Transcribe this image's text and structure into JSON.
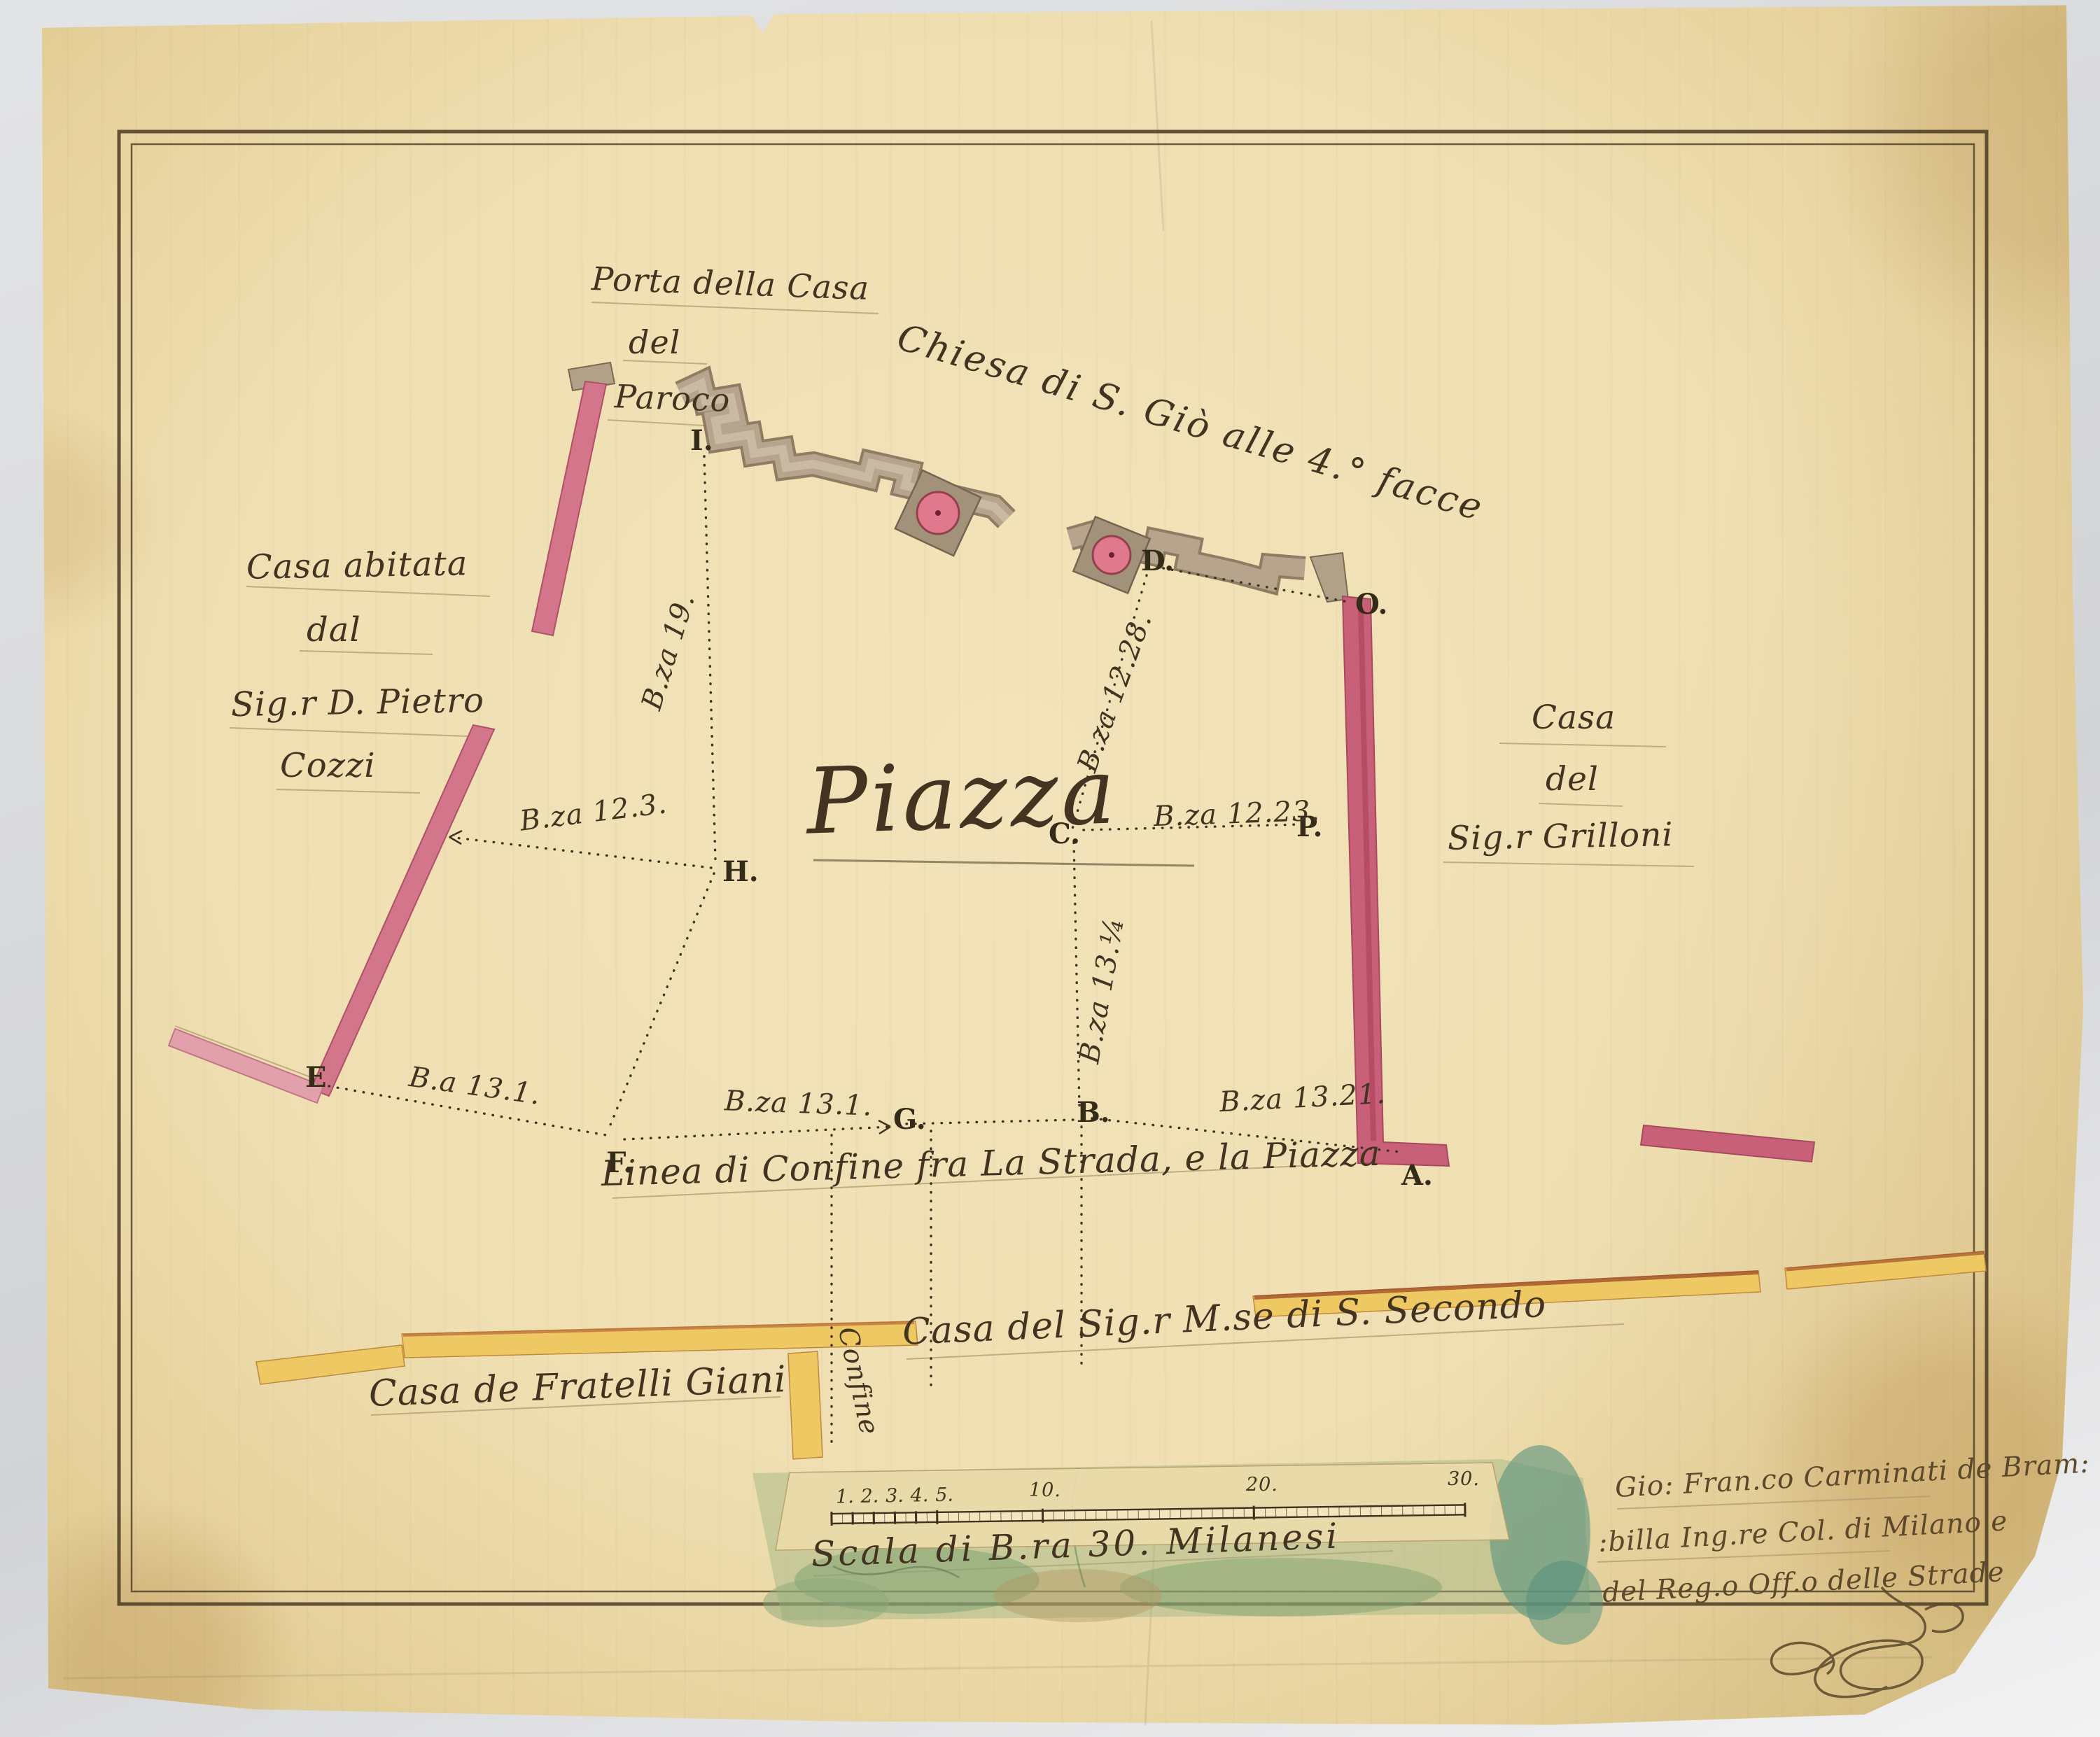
{
  "map": {
    "piazza_label": "Piazza",
    "church_label": "Chiesa di S. Giò alle 4.° facce",
    "boundary_line_label": "Linea di Confine fra La Strada, e la Piazza",
    "porta_lines": [
      "Porta della Casa",
      "del",
      "Paroco"
    ],
    "casa_cozzi_lines": [
      "Casa abitata",
      "dal",
      "Sig.r D. Pietro",
      "Cozzi"
    ],
    "casa_grilloni_lines": [
      "Casa",
      "del",
      "Sig.r Grilloni"
    ],
    "casa_giani_label": "Casa de Fratelli Giani",
    "casa_secondo_label": "Casa del Sig.r M.se di S. Secondo",
    "confine_label": "Confine"
  },
  "points": {
    "I": "I.",
    "H": "H.",
    "E": "E",
    "F": "F.",
    "G": "G.",
    "B": "B.",
    "A": "A.",
    "C": "C.",
    "P": "P.",
    "D": "D.",
    "O": "O."
  },
  "measurements": {
    "ih": "B.za 19.",
    "h_left": "B.za 12.3.",
    "dc": "B.za 12.28.",
    "cp": "B.za 12.23.",
    "cb": "B.za 13.¼",
    "ef": "B.a 13.1.",
    "fg": "B.za 13.1.",
    "ba": "B.za 13.21."
  },
  "scale": {
    "caption": "Scala di B.ra 30. Milanesi",
    "ticks": [
      "1.",
      "2.",
      "3.",
      "4.",
      "5.",
      "10.",
      "20.",
      "30."
    ]
  },
  "signature_lines": [
    "Gio: Fran.co Carminati de Bram:",
    ":billa Ing.re Col. di Milano e",
    "del Reg.o Off.o delle Strade"
  ],
  "colors": {
    "ink": "#42351f",
    "paper": "#efdfb2",
    "wall_red": "#d3758b",
    "wall_church_grey": "#b6a48c",
    "house_yellow": "#eec862",
    "wash_green": "#8fae7e"
  }
}
